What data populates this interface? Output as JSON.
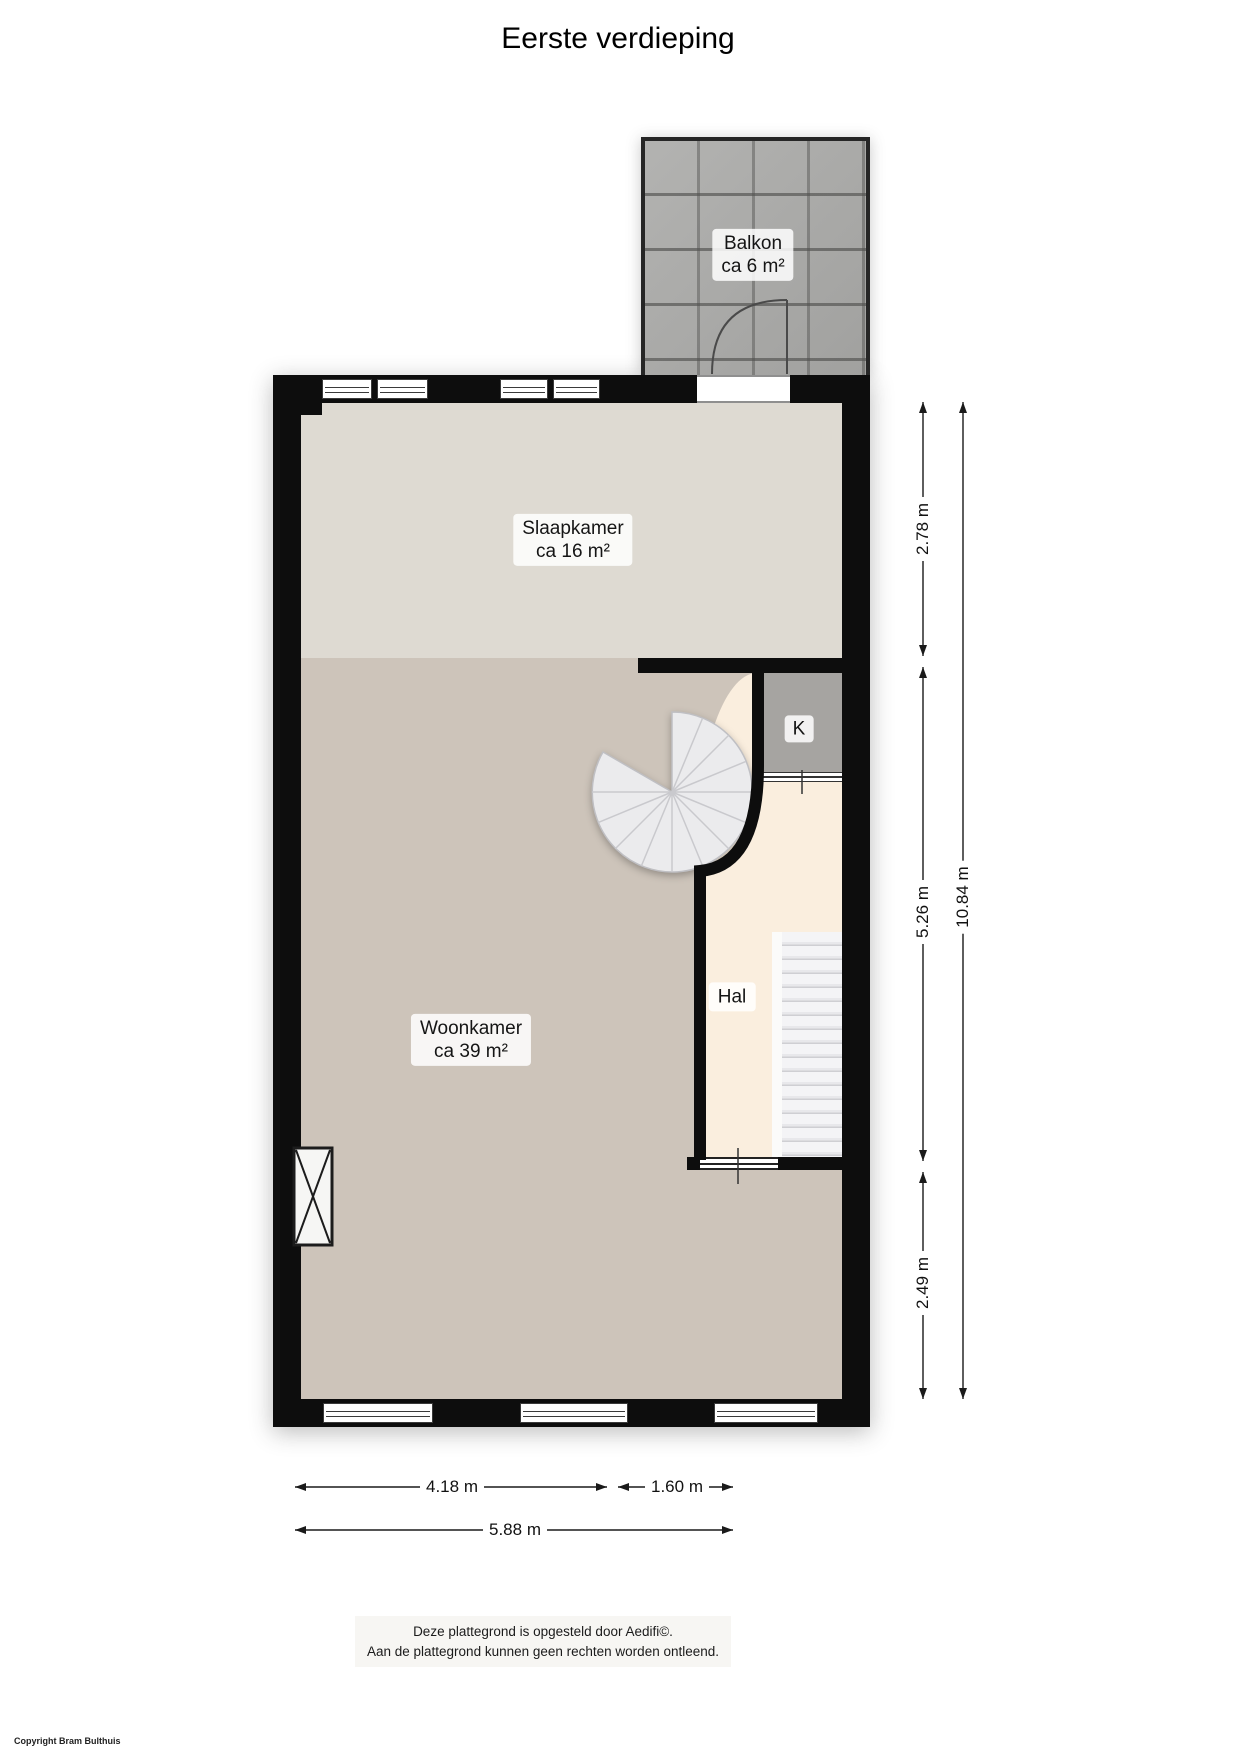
{
  "title": "Eerste verdieping",
  "rooms": {
    "balkon": {
      "name": "Balkon",
      "area": "ca 6 m²"
    },
    "slaapkamer": {
      "name": "Slaapkamer",
      "area": "ca 16 m²"
    },
    "woonkamer": {
      "name": "Woonkamer",
      "area": "ca 39 m²"
    },
    "hal": {
      "name": "Hal"
    },
    "keuken": {
      "name": "K"
    }
  },
  "dimensions": {
    "right": {
      "seg1": "2.78 m",
      "seg2": "5.26 m",
      "seg3": "2.49 m",
      "total": "10.84 m"
    },
    "bottom": {
      "seg1": "4.18 m",
      "seg2": "1.60 m",
      "total": "5.88 m"
    }
  },
  "footer": {
    "line1": "Deze plattegrond is opgesteld door Aedifi©.",
    "line2": "Aan de plattegrond kunnen geen rechten worden ontleend."
  },
  "copyright": "Copyright Bram Bulthuis",
  "colors": {
    "wall": "#0d0d0d",
    "slaapkamer_floor": "#dedad2",
    "woonkamer_floor": "#cdc4ba",
    "hal_floor": "#faeede",
    "keuken_floor": "#a6a4a1",
    "balkon_tile": "#adadab",
    "stair_tread": "#ececee"
  }
}
